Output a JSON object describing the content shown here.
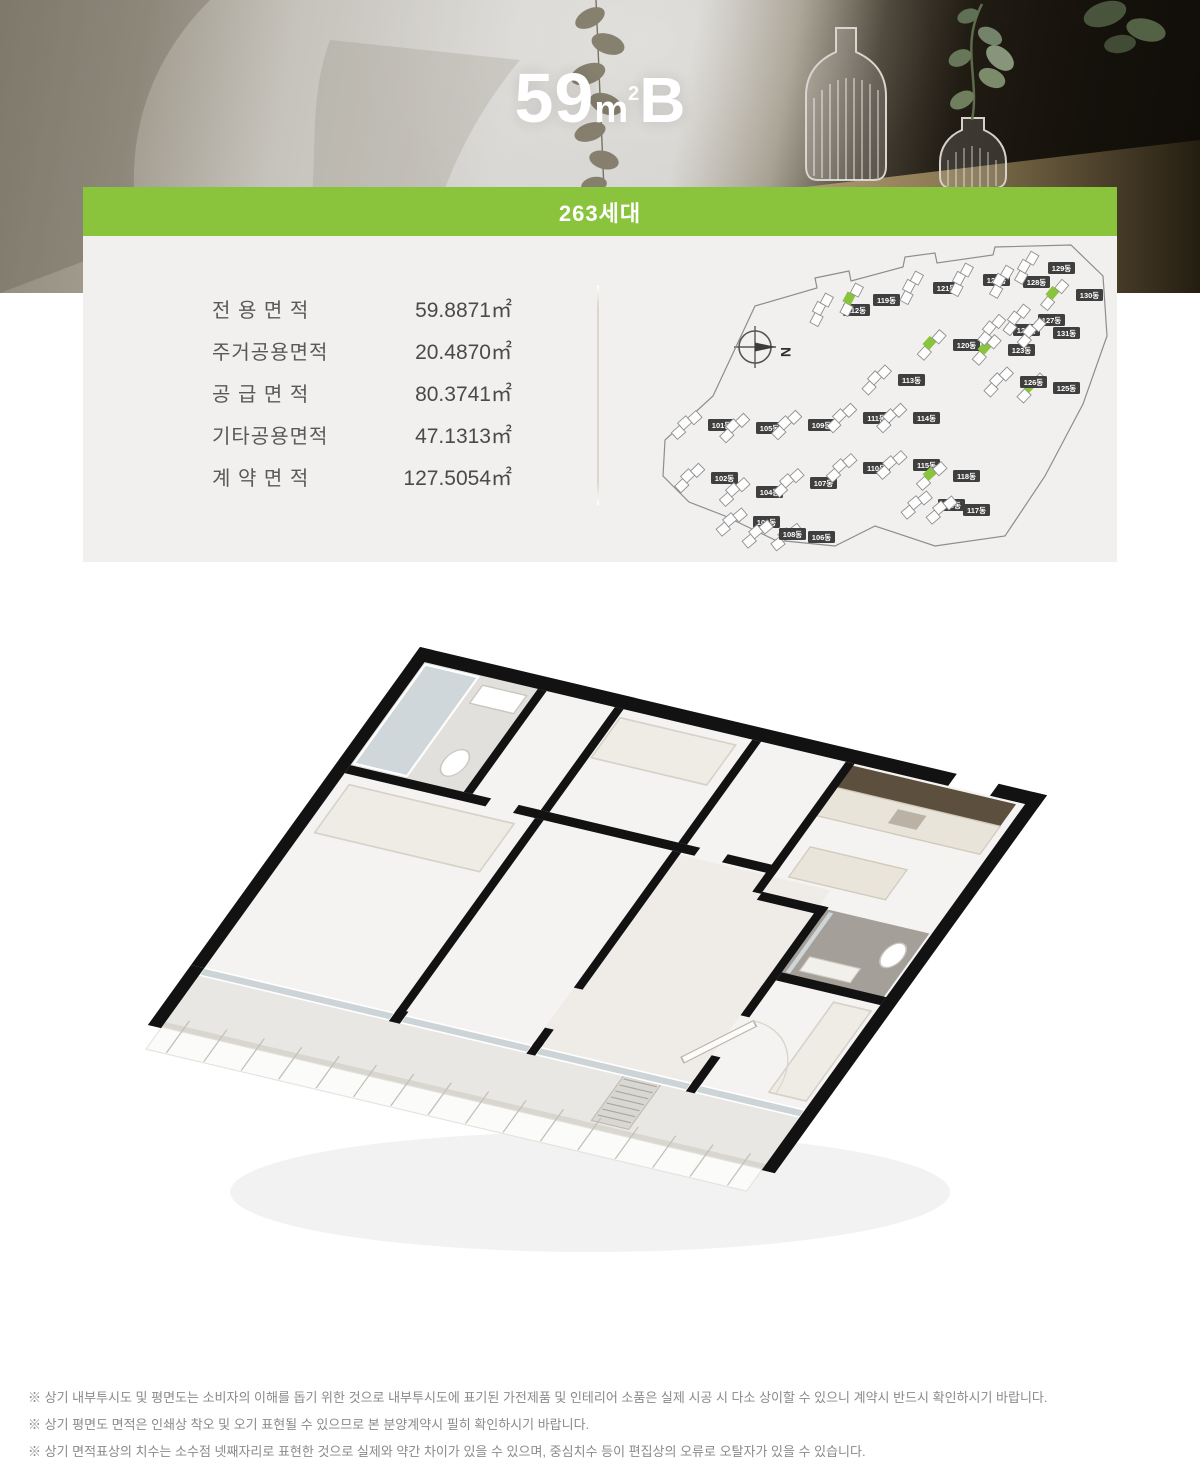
{
  "header": {
    "title_number": "59",
    "title_unit": "m",
    "title_sup": "2",
    "title_type": "B",
    "banner_label": "263세대"
  },
  "area_table": {
    "rows": [
      {
        "label": "전 용 면 적",
        "value": "59.8871㎡"
      },
      {
        "label": "주거공용면적",
        "value": "20.4870㎡"
      },
      {
        "label": "공 급 면 적",
        "value": "80.3741㎡"
      },
      {
        "label": "기타공용면적",
        "value": "47.1313㎡"
      },
      {
        "label": "계 약 면 적",
        "value": "127.5054㎡"
      }
    ]
  },
  "site_plan": {
    "compass_label": "N",
    "buildings": [
      {
        "label": "101동",
        "x": 97,
        "y": 181,
        "rot": -42,
        "green": false
      },
      {
        "label": "102동",
        "x": 100,
        "y": 234,
        "rot": -44,
        "green": false
      },
      {
        "label": "103동",
        "x": 142,
        "y": 278,
        "rot": -40,
        "green": false
      },
      {
        "label": "104동",
        "x": 145,
        "y": 248,
        "rot": -42,
        "green": false
      },
      {
        "label": "105동",
        "x": 145,
        "y": 184,
        "rot": -44,
        "green": false
      },
      {
        "label": "106동",
        "x": 197,
        "y": 293,
        "rot": -38,
        "green": false
      },
      {
        "label": "107동",
        "x": 199,
        "y": 239,
        "rot": -42,
        "green": false
      },
      {
        "label": "108동",
        "x": 168,
        "y": 290,
        "rot": -40,
        "green": false
      },
      {
        "label": "109동",
        "x": 197,
        "y": 181,
        "rot": -44,
        "green": false
      },
      {
        "label": "110동",
        "x": 252,
        "y": 224,
        "rot": -42,
        "green": false
      },
      {
        "label": "111동",
        "x": 252,
        "y": 174,
        "rot": -44,
        "green": false
      },
      {
        "label": "112동",
        "x": 232,
        "y": 66,
        "rot": -62,
        "green": false
      },
      {
        "label": "113동",
        "x": 287,
        "y": 136,
        "rot": -46,
        "green": false
      },
      {
        "label": "114동",
        "x": 302,
        "y": 174,
        "rot": -44,
        "green": false
      },
      {
        "label": "115동",
        "x": 302,
        "y": 221,
        "rot": -42,
        "green": false
      },
      {
        "label": "116동",
        "x": 327,
        "y": 261,
        "rot": -40,
        "green": false
      },
      {
        "label": "117동",
        "x": 352,
        "y": 266,
        "rot": -40,
        "green": false
      },
      {
        "label": "118동",
        "x": 342,
        "y": 232,
        "rot": -42,
        "green": true
      },
      {
        "label": "119동",
        "x": 262,
        "y": 56,
        "rot": -62,
        "green": true
      },
      {
        "label": "120동",
        "x": 342,
        "y": 101,
        "rot": -48,
        "green": true
      },
      {
        "label": "121동",
        "x": 322,
        "y": 44,
        "rot": -62,
        "green": false
      },
      {
        "label": "122동",
        "x": 372,
        "y": 36,
        "rot": -62,
        "green": false
      },
      {
        "label": "123동",
        "x": 397,
        "y": 106,
        "rot": -48,
        "green": true
      },
      {
        "label": "124동",
        "x": 402,
        "y": 86,
        "rot": -50,
        "green": false
      },
      {
        "label": "125동",
        "x": 442,
        "y": 144,
        "rot": -46,
        "green": true
      },
      {
        "label": "126동",
        "x": 409,
        "y": 138,
        "rot": -46,
        "green": false
      },
      {
        "label": "127동",
        "x": 427,
        "y": 76,
        "rot": -52,
        "green": false
      },
      {
        "label": "128동",
        "x": 412,
        "y": 38,
        "rot": -60,
        "green": false
      },
      {
        "label": "129동",
        "x": 437,
        "y": 24,
        "rot": -60,
        "green": false
      },
      {
        "label": "130동",
        "x": 465,
        "y": 51,
        "rot": -50,
        "green": true
      },
      {
        "label": "131동",
        "x": 442,
        "y": 89,
        "rot": -48,
        "green": false
      }
    ]
  },
  "disclaimers": [
    "※ 상기 내부투시도 및 평면도는 소비자의 이해를 돕기 위한 것으로 내부투시도에 표기된 가전제품 및 인테리어 소품은 실제 시공 시 다소 상이할 수 있으니 계약시 반드시 확인하시기 바랍니다.",
    "※ 상기 평면도 면적은 인쇄상 착오 및 오기 표현될 수 있으므로 본 분양계약시 필히 확인하시기 바랍니다.",
    "※ 상기 면적표상의 치수는 소수점 넷째자리로 표현한 것으로 실제와 약간 차이가 있을 수 있으며, 중심치수 등이 편집상의 오류로 오탈자가 있을 수 있습니다."
  ],
  "colors": {
    "accent_green": "#8ac43d",
    "panel_bg": "#f1f0ee",
    "wall_black": "#121212",
    "badge_dark": "#3f3f3f"
  }
}
